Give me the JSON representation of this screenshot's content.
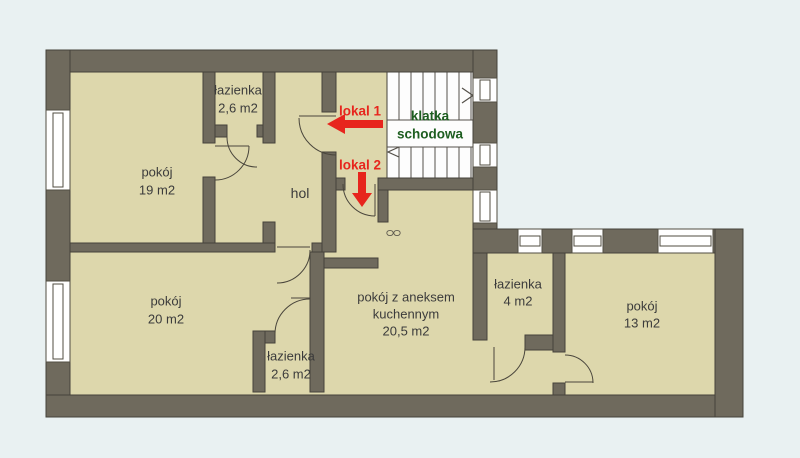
{
  "plan": {
    "type": "apartment-floor-plan",
    "rooms": [
      {
        "id": "pokoj-19",
        "lines": [
          "pokój",
          "19 m2"
        ]
      },
      {
        "id": "lazienka-top",
        "lines": [
          "łazienka",
          "2,6 m2"
        ]
      },
      {
        "id": "hol",
        "lines": [
          "hol"
        ]
      },
      {
        "id": "pokoj-20",
        "lines": [
          "pokój",
          "20 m2"
        ]
      },
      {
        "id": "lazienka-bottom",
        "lines": [
          "łazienka",
          "2,6 m2"
        ]
      },
      {
        "id": "pokoj-aneks",
        "lines": [
          "pokój z aneksem",
          "kuchennym",
          "20,5 m2"
        ]
      },
      {
        "id": "lazienka-4",
        "lines": [
          "łazienka",
          "4 m2"
        ]
      },
      {
        "id": "pokoj-13",
        "lines": [
          "pokój",
          "13 m2"
        ]
      }
    ],
    "annotations": {
      "unit1": "lokal 1",
      "unit2": "lokal 2",
      "staircase": [
        "klatka",
        "schodowa"
      ]
    },
    "colors": {
      "background": "#e9f1f2",
      "room_fill": "#ddd7ac",
      "wall_fill": "#6f6a5d",
      "wall_outline": "#45423a",
      "stairs_fill": "#ffffff",
      "label_text": "#3b3b3b",
      "unit_accent": "#e7251d",
      "staircase_accent": "#1d5e20"
    }
  }
}
